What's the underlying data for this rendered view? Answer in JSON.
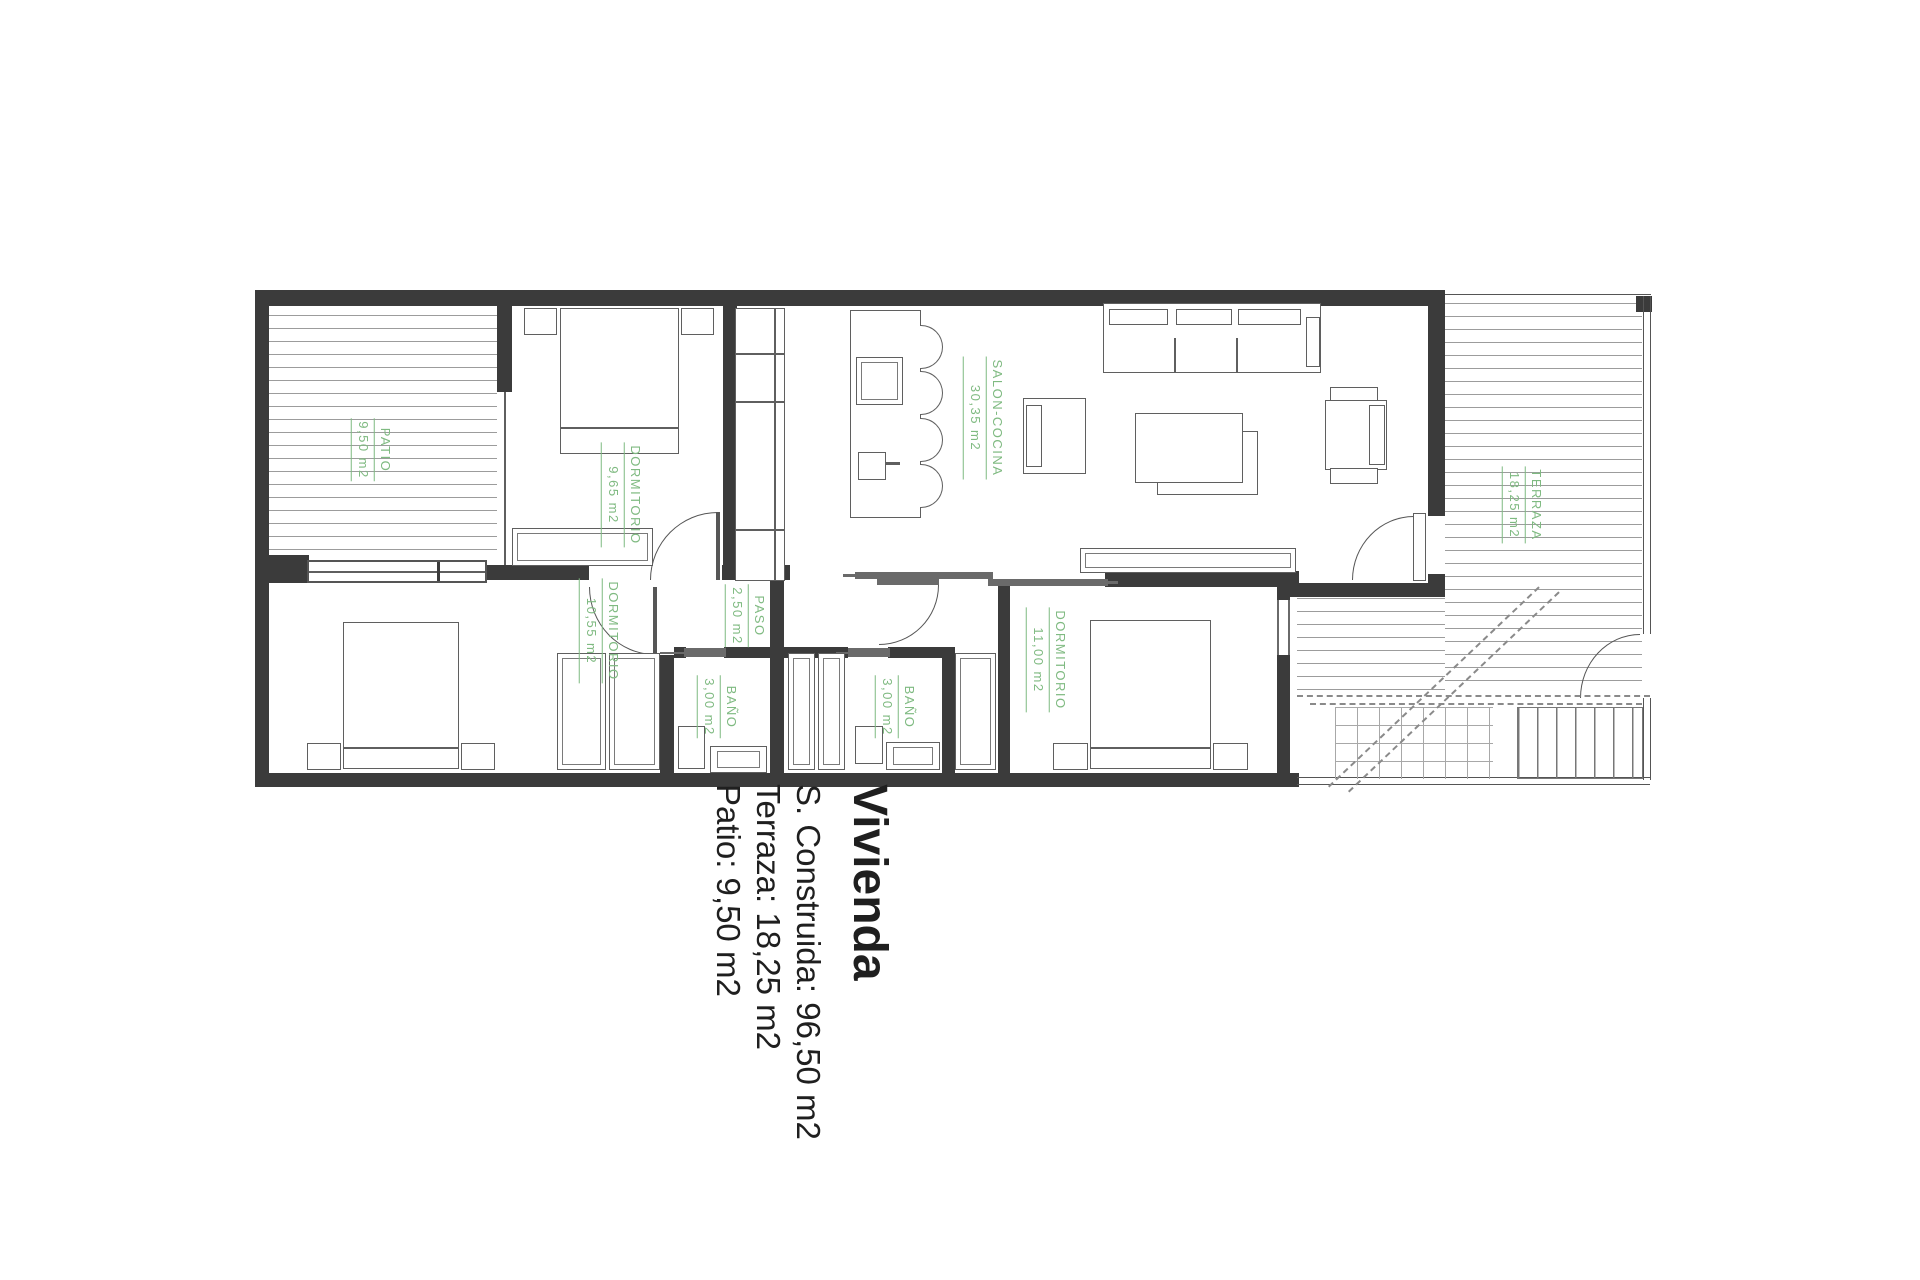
{
  "caption": {
    "title": "Vivienda",
    "line1": "S. Construida: 96,50 m2",
    "line2": "Terraza: 18,25 m2",
    "line3": "Patio: 9,50 m2"
  },
  "rooms": {
    "patio": {
      "name": "PATIO",
      "area": "9,50 m2"
    },
    "dormitorio1": {
      "name": "DORMITORIO",
      "area": "9,65 m2"
    },
    "salon": {
      "name": "SALON-COCINA",
      "area": "30,35 m2"
    },
    "terraza": {
      "name": "TERRAZA",
      "area": "18,25 m2"
    },
    "dormitorio2": {
      "name": "DORMITORIO",
      "area": "10,55 m2"
    },
    "bano1": {
      "name": "BAÑO",
      "area": "3,00 m2"
    },
    "paso": {
      "name": "PASO",
      "area": "2,50 m2"
    },
    "bano2": {
      "name": "BAÑO",
      "area": "3,00 m2"
    },
    "dormitorio3": {
      "name": "DORMITORIO",
      "area": "11,00 m2"
    }
  },
  "colors": {
    "label_green": "#7fba81",
    "wall": "#3b3b3b",
    "caption_text": "#1f1f1f"
  }
}
